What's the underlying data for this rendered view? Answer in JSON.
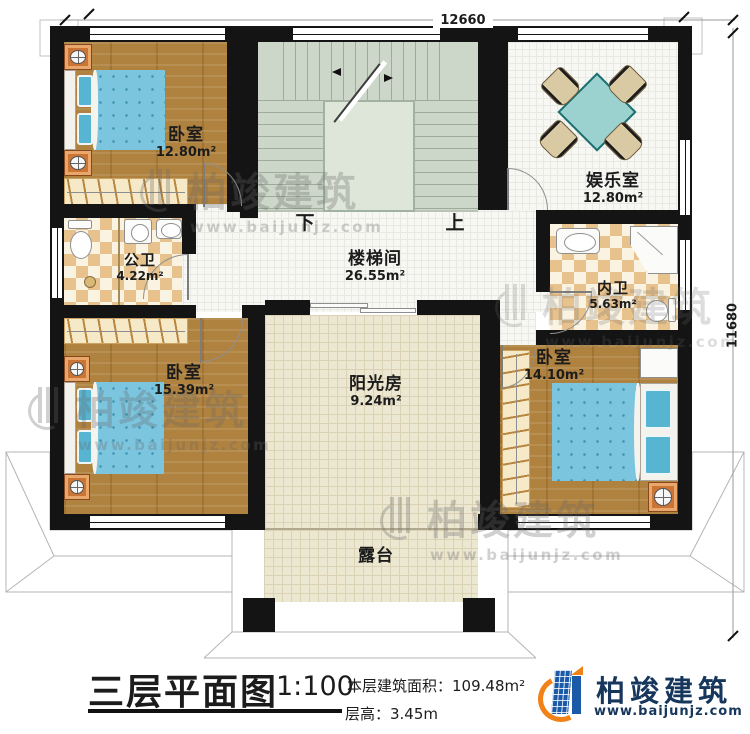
{
  "watermark": {
    "brand": "柏竣建筑",
    "url": "www.baijunjz.com"
  },
  "dimensions": {
    "top": "12660",
    "right": "11680"
  },
  "stairs": {
    "down": "下",
    "up": "上"
  },
  "rooms": {
    "bedroom_tl": {
      "name": "卧室",
      "area": "12.80m²"
    },
    "entertainment": {
      "name": "娱乐室",
      "area": "12.80m²"
    },
    "public_bath": {
      "name": "公卫",
      "area": "4.22m²"
    },
    "stairwell": {
      "name": "楼梯间",
      "area": "26.55m²"
    },
    "ensuite_bath": {
      "name": "内卫",
      "area": "5.63m²"
    },
    "bedroom_bl": {
      "name": "卧室",
      "area": "15.39m²"
    },
    "sunroom": {
      "name": "阳光房",
      "area": "9.24m²"
    },
    "bedroom_br": {
      "name": "卧室",
      "area": "14.10m²"
    },
    "terrace": {
      "name": "露台"
    }
  },
  "titleblock": {
    "title": "三层平面图",
    "scale": "1:100",
    "floor_area": "本层建筑面积：109.48m²",
    "floor_height": "层高：3.45m",
    "brand": "柏竣建筑",
    "brand_url": "www.baijunjz.com"
  },
  "colors": {
    "wall": "#141414",
    "wood": "#b0823f",
    "bed_blue": "#7cc5de",
    "stair_floor": "#ccd7c9",
    "tile_beige": "#ece7d1",
    "checker_tan": "#e8c28d",
    "logo_blue": "#1a5aa8",
    "logo_orange": "#f08217"
  }
}
